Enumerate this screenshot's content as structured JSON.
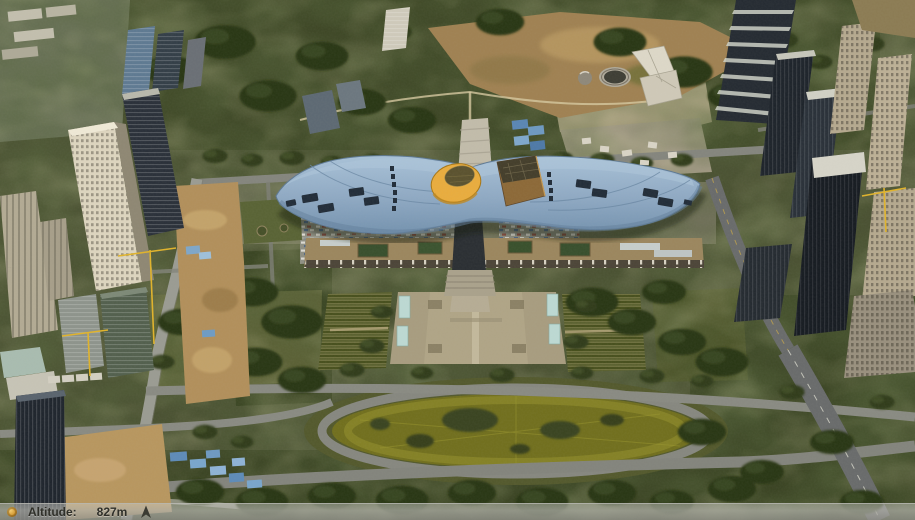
{
  "status_bar": {
    "altitude_label": "Altitude:",
    "altitude_value": "827m",
    "icons": {
      "left": "altitude-dot-icon",
      "right": "north-arrow-icon"
    }
  },
  "palette": {
    "roof_blue": "#8fa9c3",
    "roof_highlight": "#aec6da",
    "roof_shadow": "#64809c",
    "cone_yellow": "#e9ad3f",
    "pavilion_brown": "#8d6a39",
    "lawn_olive": "#72701f",
    "plaza_tan": "#a89d80",
    "tree_dark": "#333e1e",
    "road_gray": "#8a8b83",
    "dirt_tan": "#b2905c",
    "status_text": "#30302a"
  }
}
